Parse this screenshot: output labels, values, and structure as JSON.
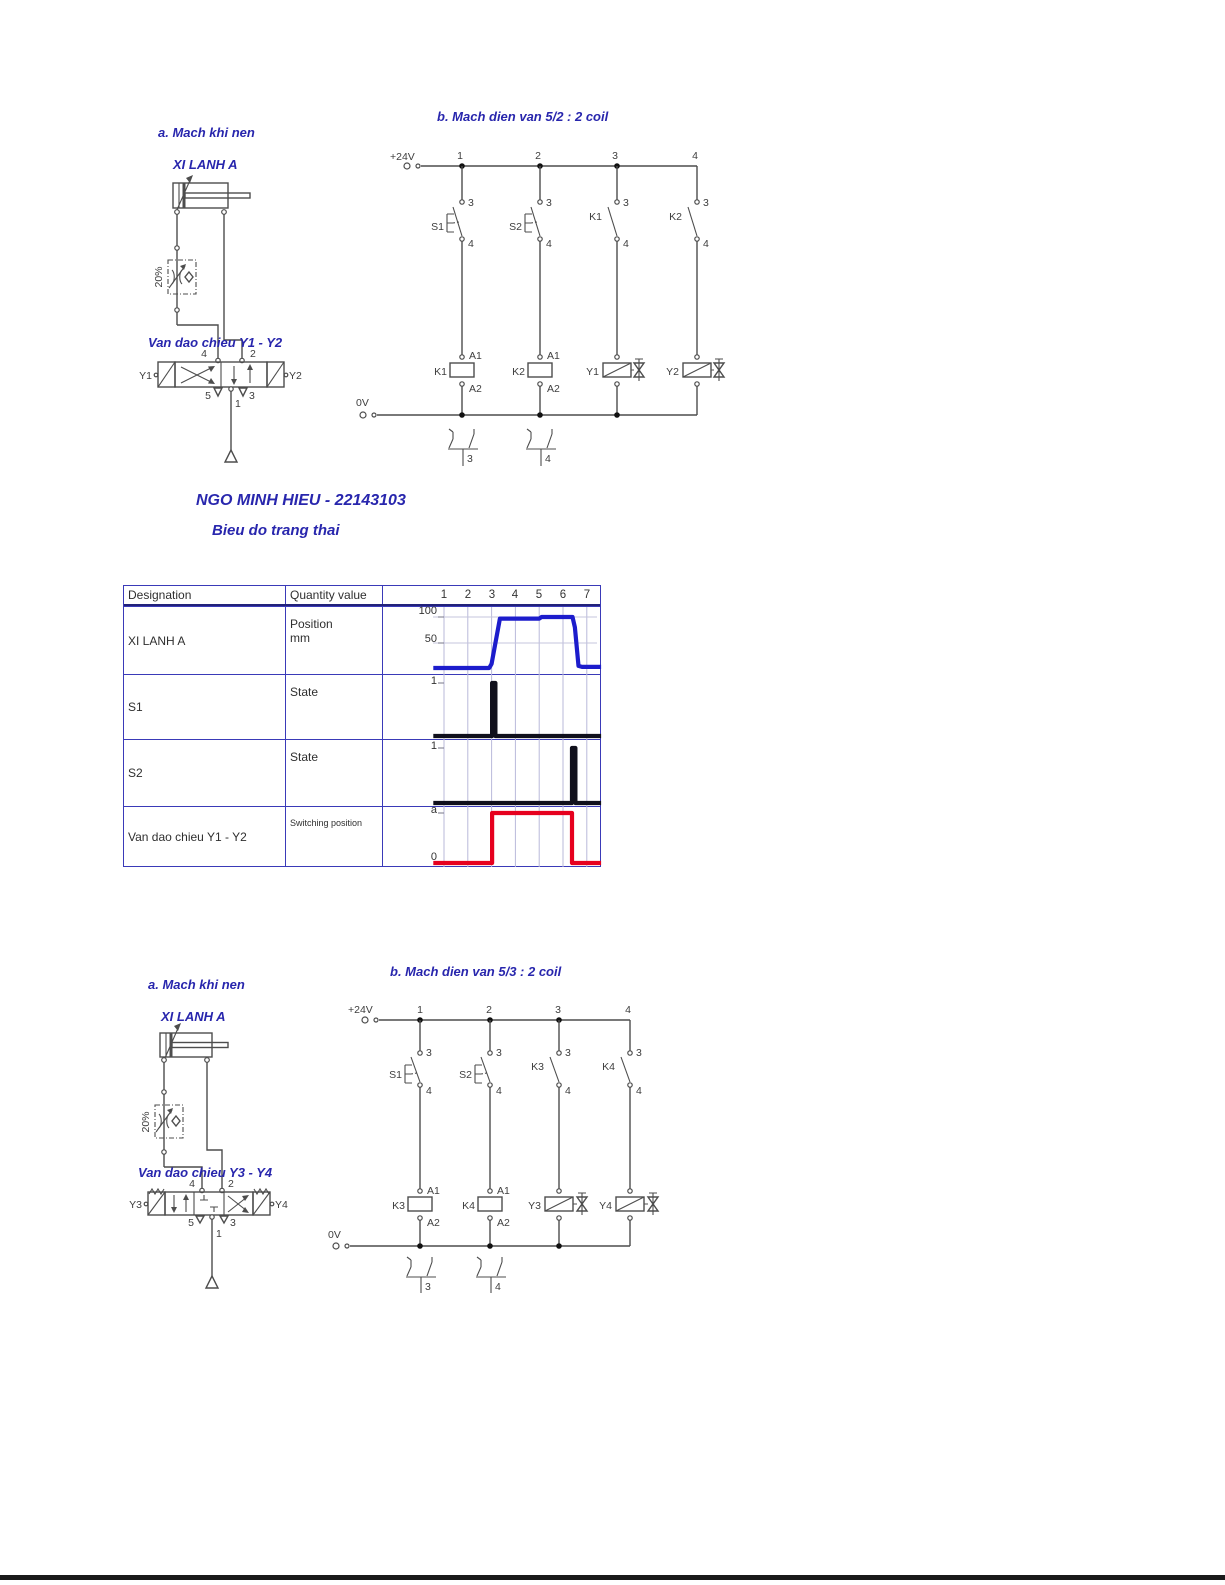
{
  "top_pneumatic": {
    "section_title": "a. Mach khi nen",
    "cylinder_label": "XI LANH A",
    "flow_label": "20%",
    "valve_label": "Van dao chieu Y1 - Y2",
    "port_top_left": "4",
    "port_top_right": "2",
    "port_bot_left": "5",
    "port_bot_mid": "1",
    "port_bot_right": "3",
    "sol_left": "Y1",
    "sol_right": "Y2"
  },
  "top_electrical": {
    "title": "b. Mach dien van 5/2 : 2 coil",
    "pos_rail": "+24V",
    "neg_rail": "0V",
    "cols": [
      "1",
      "2",
      "3",
      "4"
    ],
    "contacts": [
      "S1",
      "S2",
      "K1",
      "K2"
    ],
    "t_top": "3",
    "t_bot": "4",
    "coils": [
      "K1",
      "K2"
    ],
    "solenoids": [
      "Y1",
      "Y2"
    ],
    "a1": "A1",
    "a2": "A2",
    "refs": [
      "3",
      "4"
    ]
  },
  "heading": {
    "student": "NGO MINH HIEU - 22143103",
    "subtitle": "Bieu do trang thai"
  },
  "state_table": {
    "col_designation": "Designation",
    "col_quantity": "Quantity value",
    "x_ticks": [
      "1",
      "2",
      "3",
      "4",
      "5",
      "6",
      "7"
    ],
    "rows": [
      {
        "designation": "XI LANH A",
        "quantity": "Position",
        "unit": "mm",
        "tick_a": "100",
        "tick_b": "50"
      },
      {
        "designation": "S1",
        "quantity": "State",
        "tick_a": "1"
      },
      {
        "designation": "S2",
        "quantity": "State",
        "tick_a": "1"
      },
      {
        "designation": "Van dao chieu Y1 - Y2",
        "quantity": "Switching position",
        "tick_a": "a",
        "tick_b": "0"
      }
    ]
  },
  "chart_data": {
    "type": "line",
    "title": "Bieu do trang thai",
    "x_ticks": [
      1,
      2,
      3,
      4,
      5,
      6,
      7
    ],
    "x_range": [
      0.55,
      7.6
    ],
    "charts": [
      {
        "name": "XI LANH A",
        "ylabel": "Position (mm)",
        "color": "#1c1ccc",
        "yticks": [
          100,
          50
        ],
        "ygrid": true,
        "ymax_tick": 100,
        "ylim": [
          0,
          110
        ],
        "points": [
          [
            0.55,
            2
          ],
          [
            2.9,
            2
          ],
          [
            3.0,
            10
          ],
          [
            3.35,
            97
          ],
          [
            5.0,
            97
          ],
          [
            5.1,
            100
          ],
          [
            6.4,
            100
          ],
          [
            6.5,
            80
          ],
          [
            6.65,
            6
          ],
          [
            6.8,
            4
          ],
          [
            7.6,
            4
          ]
        ]
      },
      {
        "name": "S1",
        "ylabel": "State",
        "color": "#10101c",
        "yticks": [
          1
        ],
        "ygrid": false,
        "ymax_tick": 1,
        "ylim": [
          0,
          1.15
        ],
        "points": [
          [
            0.55,
            0
          ],
          [
            3.02,
            0
          ],
          [
            3.02,
            1
          ],
          [
            3.16,
            1
          ],
          [
            3.16,
            0
          ],
          [
            7.6,
            0
          ]
        ]
      },
      {
        "name": "S2",
        "ylabel": "State",
        "color": "#10101c",
        "yticks": [
          1
        ],
        "ygrid": false,
        "ymax_tick": 1,
        "ylim": [
          0,
          1.15
        ],
        "points": [
          [
            0.55,
            0
          ],
          [
            6.38,
            0
          ],
          [
            6.38,
            1
          ],
          [
            6.52,
            1
          ],
          [
            6.52,
            0
          ],
          [
            7.6,
            0
          ]
        ]
      },
      {
        "name": "Van dao chieu Y1 - Y2",
        "ylabel": "Switching position",
        "color": "#e6001e",
        "yticks": [
          1,
          0
        ],
        "yticklabels": [
          "a",
          "0"
        ],
        "ygrid": false,
        "ymax_tick": 1,
        "ylim": [
          0,
          1.15
        ],
        "points": [
          [
            0.55,
            0
          ],
          [
            3.02,
            0
          ],
          [
            3.02,
            1
          ],
          [
            6.38,
            1
          ],
          [
            6.38,
            0
          ],
          [
            7.6,
            0
          ]
        ]
      }
    ]
  },
  "bottom_pneumatic": {
    "section_title": "a. Mach khi nen",
    "cylinder_label": "XI LANH A",
    "flow_label": "20%",
    "valve_label": "Van dao chieu Y3 - Y4",
    "port_top_left": "4",
    "port_top_right": "2",
    "port_bot_left": "5",
    "port_bot_mid": "1",
    "port_bot_right": "3",
    "sol_left": "Y3",
    "sol_right": "Y4"
  },
  "bottom_electrical": {
    "title": "b. Mach dien van 5/3 : 2 coil",
    "pos_rail": "+24V",
    "neg_rail": "0V",
    "cols": [
      "1",
      "2",
      "3",
      "4"
    ],
    "contacts": [
      "S1",
      "S2",
      "K3",
      "K4"
    ],
    "t_top": "3",
    "t_bot": "4",
    "coils": [
      "K3",
      "K4"
    ],
    "solenoids": [
      "Y3",
      "Y4"
    ],
    "a1": "A1",
    "a2": "A2",
    "refs": [
      "3",
      "4"
    ]
  }
}
